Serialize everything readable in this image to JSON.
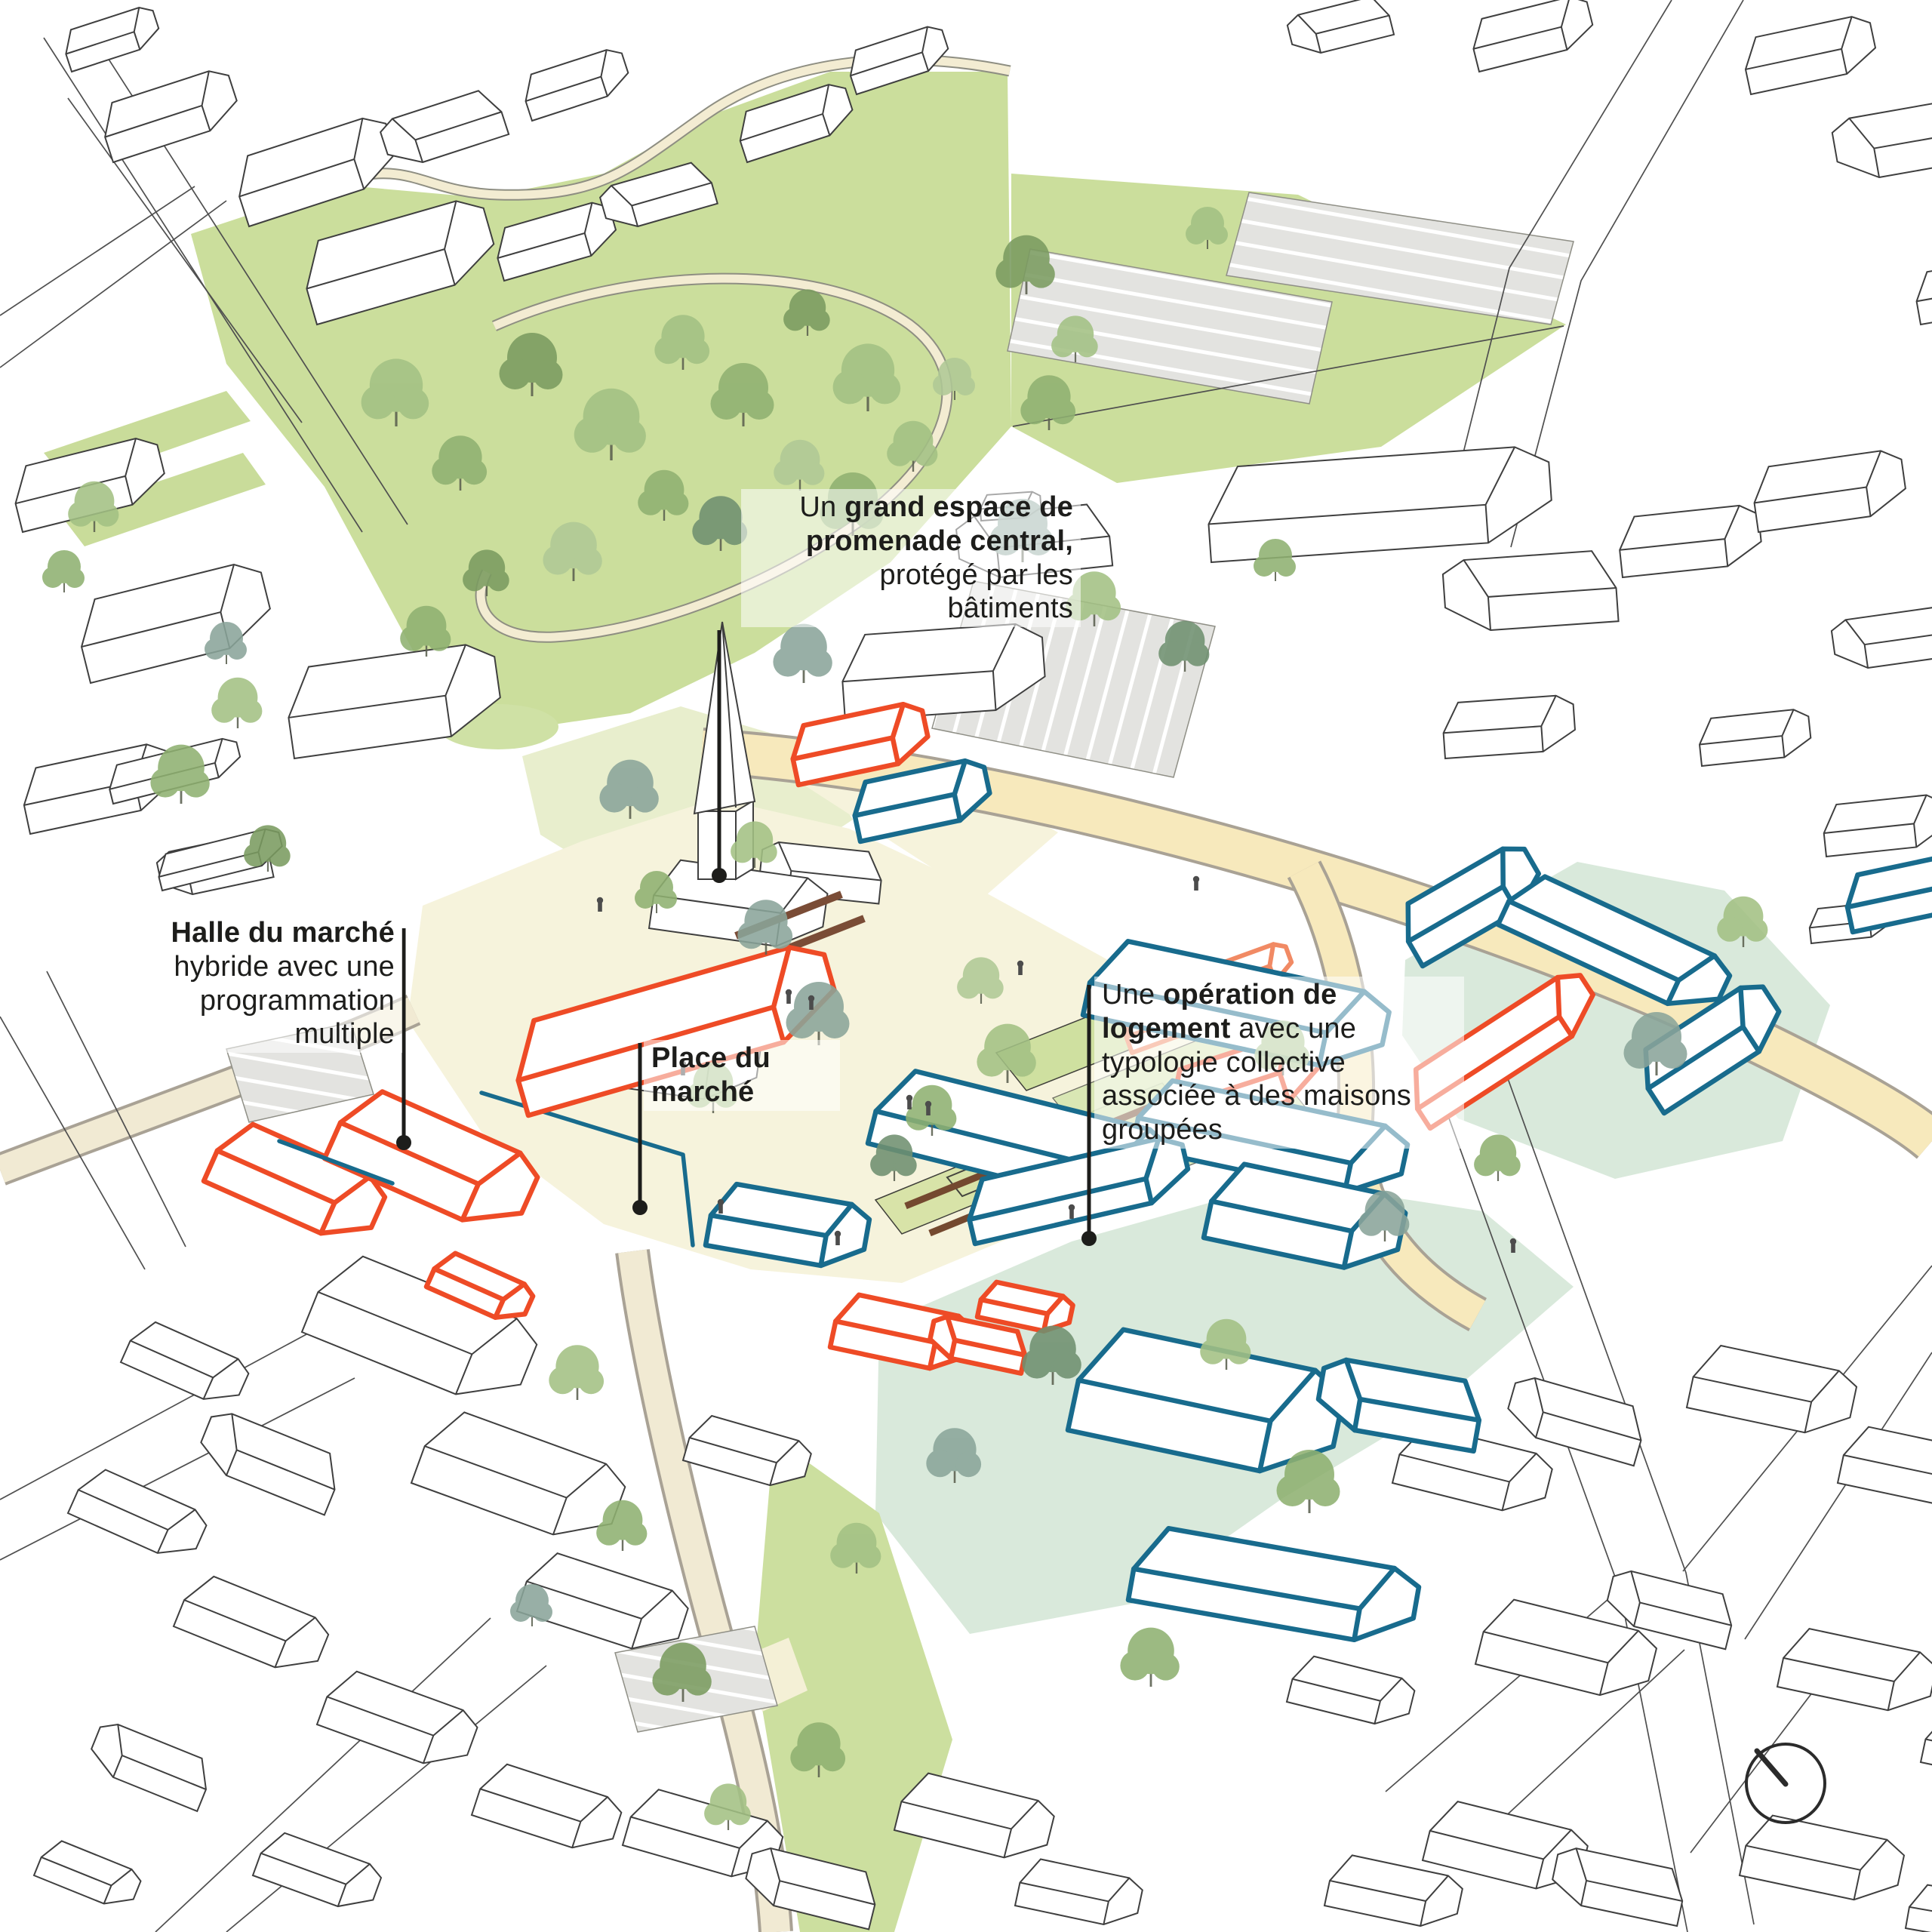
{
  "annotations": {
    "promenade": {
      "pre": "Un ",
      "bold": "grand espace de promenade central,",
      "post": " protégé par les bâtiments"
    },
    "halle": {
      "pre": "",
      "bold": "Halle du marché",
      "post": " hybride avec une programmation multiple"
    },
    "place_du_marche": {
      "pre": "",
      "bold": "Place du marché",
      "post": ""
    },
    "logement": {
      "pre": "Une ",
      "bold": "opération de logement",
      "post": " avec une typologie collective associée à des maisons groupées"
    }
  },
  "palette": {
    "new_building_blue": "#186b8d",
    "new_building_orange": "#ee4b26",
    "existing_building_outline": "#3f3f3f",
    "park_green": "#cbde9c",
    "mint_parcel_green": "#d9e9db",
    "road_yellow": "#f7e9bc",
    "path_cream": "#f1ead3",
    "plaza_cream": "#f6f3dc",
    "annotation_text": "#1d1d1b"
  },
  "icons": {
    "north_indicator": "circle-with-north-needle"
  }
}
